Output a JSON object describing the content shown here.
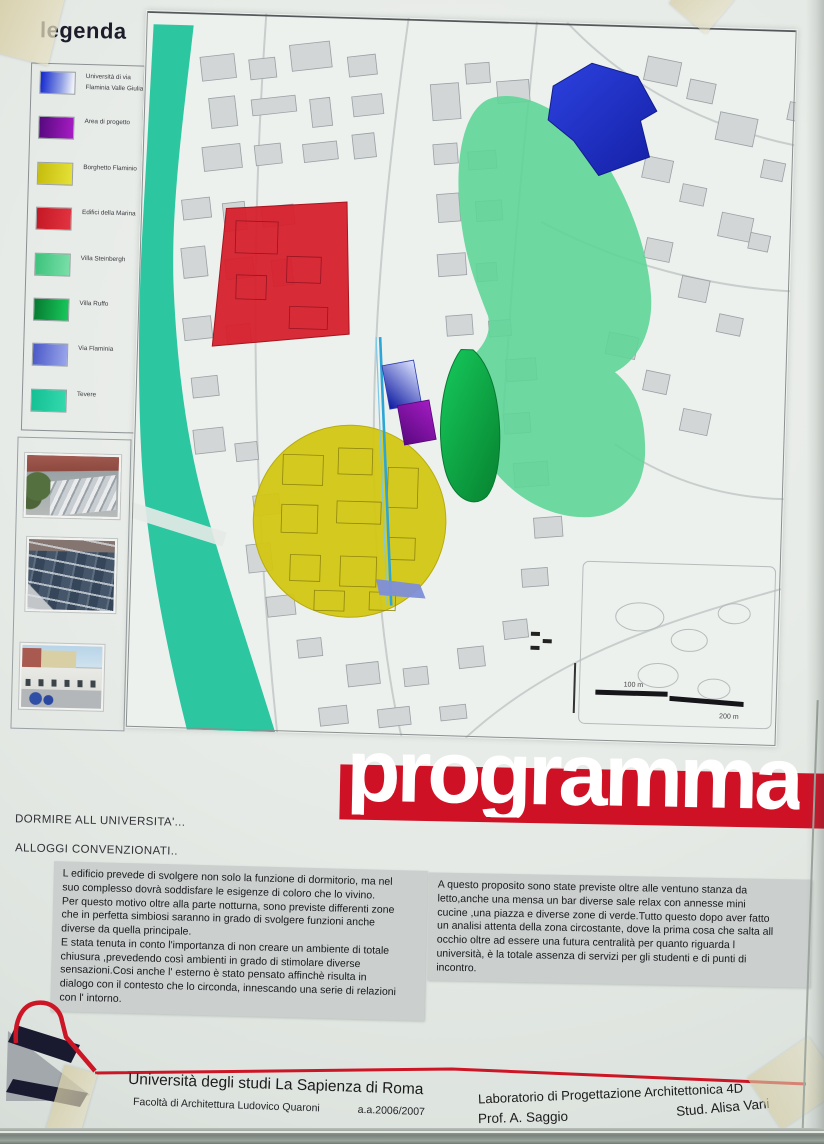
{
  "poster": {
    "legend": {
      "title": "legenda",
      "items": [
        {
          "label": "Università di via Flaminia Valle Giulia",
          "swatch": "background:linear-gradient(95deg,#1b2fd0 5%,#8e9de4 60%,#f0f2fa 95%)"
        },
        {
          "label": "Area di progetto",
          "swatch": "background:linear-gradient(95deg,#55097e,#a81cc4)"
        },
        {
          "label": "Borghetto Flaminio",
          "swatch": "background:linear-gradient(95deg,#c5bd0c,#e6e138)"
        },
        {
          "label": "Edifici della Marina",
          "swatch": "background:linear-gradient(95deg,#c41824,#e23440)"
        },
        {
          "label": "Villa Steinbergh",
          "swatch": "background:linear-gradient(95deg,#3cc27c,#7adfa8)"
        },
        {
          "label": "Villa Ruffo",
          "swatch": "background:linear-gradient(95deg,#067a30,#18c95c)"
        },
        {
          "label": "Via Flaminia",
          "swatch": "background:linear-gradient(95deg,#4a58c8,#9aa6ea)"
        },
        {
          "label": "Tevere",
          "swatch": "background:linear-gradient(95deg,#14c094,#33d9ad)"
        }
      ]
    },
    "photos": [
      {
        "name": "aerial-view-borghetto"
      },
      {
        "name": "aerial-view-market-roofs"
      },
      {
        "name": "street-view-colonnade"
      }
    ],
    "map": {
      "scale_100": "100 m",
      "scale_200": "200 m"
    },
    "banner": {
      "text": "programma"
    },
    "section": {
      "heading1": "DORMIRE ALL UNIVERSITA'...",
      "heading2": "ALLOGGI CONVENZIONATI..",
      "paragraph_left": "L edificio prevede di svolgere non solo la funzione di dormitorio, ma nel\nsuo complesso dovrà soddisfare le esigenze  di coloro che lo vivino.\nPer questo motivo oltre alla parte notturna, sono previste differenti zone\nche in perfetta simbiosi saranno in grado di svolgere funzioni anche\ndiverse da quella principale.\nE stata tenuta in conto l'importanza di non creare un ambiente di totale\nchiusura ,prevedendo così ambienti in grado di stimolare diverse\nsensazioni.Cosi anche l' esterno è stato pensato affinchè risulta in\ndialogo con il contesto che lo circonda, innescando una serie di relazioni\ncon l' intorno.",
      "paragraph_right": "A questo proposito sono state previste oltre alle ventuno stanza da\nletto,anche una mensa un bar diverse sale relax con annesse mini\ncucine ,una piazza e diverse zone di verde.Tutto questo dopo aver fatto\nun analisi attenta della zona circostante, dove la prima cosa che salta all\nocchio oltre ad essere una futura centralità per quanto riguarda l\nuniversità, è la totale assenza di servizi per gli studenti e di punti di\nincontro."
    },
    "footer": {
      "university": "Università degli studi La Sapienza di Roma",
      "faculty": "Facoltà di Architettura Ludovico Quaroni",
      "year": "a.a.2006/2007",
      "lab": "Laboratorio di Progettazione Architettonica 4D",
      "professor": "Prof. A. Saggio",
      "student": "Stud. Alisa Vani"
    },
    "colors": {
      "banner_red": "#cf1126",
      "river_teal": "#2cc6a0",
      "zone_yellow": "#d3c613",
      "zone_red": "#d6202c",
      "zone_green": "#0fa94a",
      "zone_light_green": "#5fd598",
      "zone_blue": "#1f30c4",
      "zone_purple": "#8a12b0",
      "via_flaminia_blue": "#7e8ed8"
    }
  }
}
